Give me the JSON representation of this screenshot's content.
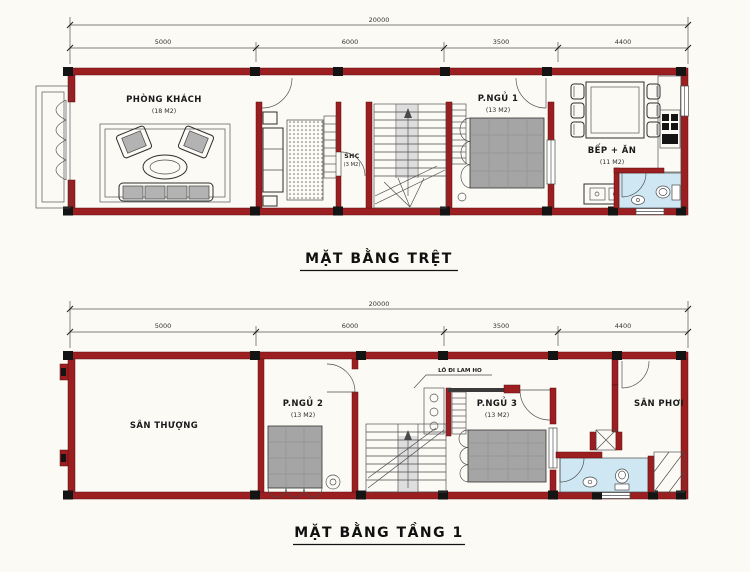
{
  "colors": {
    "wall": "#9b1e21",
    "column": "#141414",
    "line": "#2d2d2d",
    "mattress": "#a5a5a5",
    "bath_floor": "#cfe7f3",
    "landing": "#dedede",
    "background": "#fbfaf5"
  },
  "floor1": {
    "title": "MẶT BẰNG TRỆT",
    "dim_total": "20000",
    "dims": [
      "5000",
      "6000",
      "3500",
      "4400"
    ],
    "rooms": {
      "living": {
        "name": "PHÒNG KHÁCH",
        "area": "(18 M2)"
      },
      "shc": {
        "name": "SHC",
        "area": "(3 M2)"
      },
      "bed1": {
        "name": "P.NGỦ 1",
        "area": "(13 M2)"
      },
      "kitchen": {
        "name": "BẾP + ĂN",
        "area": "(11 M2)"
      }
    }
  },
  "floor2": {
    "title": "MẶT BẰNG TẦNG 1",
    "dim_total": "20000",
    "dims": [
      "5000",
      "6000",
      "3500",
      "4400"
    ],
    "rooms": {
      "terrace": {
        "name": "SÂN THƯỢNG"
      },
      "bed2": {
        "name": "P.NGỦ 2",
        "area": "(13 M2)"
      },
      "note": {
        "name": "LÔ ĐI LAM HO"
      },
      "bed3": {
        "name": "P.NGỦ 3",
        "area": "(13 M2)"
      },
      "drying": {
        "name": "SÂN PHƠI"
      }
    }
  }
}
